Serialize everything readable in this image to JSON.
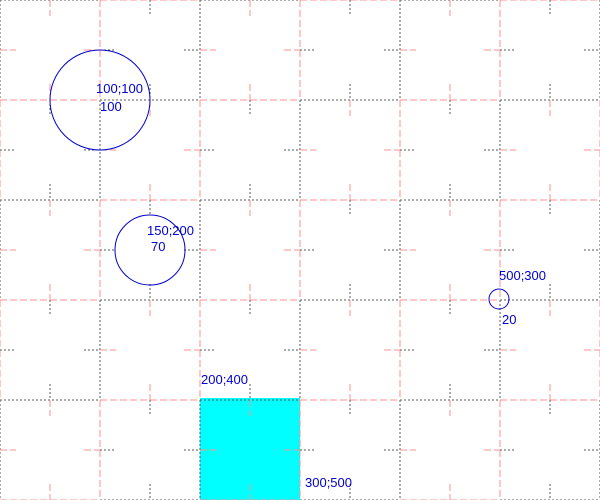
{
  "canvas": {
    "width": 600,
    "height": 500,
    "background_color": "#FFFFFF"
  },
  "grid": {
    "spacing": 100,
    "tick_half_length": 16,
    "dark_color": "#5A5A5A",
    "pink_color": "#FF9191",
    "dark_dash": "2,2",
    "pink_dash": "7,3"
  },
  "shapes": {
    "stroke_color": "#0000CC",
    "circles": [
      {
        "cx": 100,
        "cy": 100,
        "r": 50,
        "coord_label": "100;100",
        "size_label": "100"
      },
      {
        "cx": 150,
        "cy": 250,
        "r": 35,
        "coord_label": "150;200",
        "size_label": "70"
      },
      {
        "cx": 499,
        "cy": 299,
        "r": 10,
        "coord_label": "500;300",
        "size_label": "20"
      }
    ],
    "rect": {
      "x": 200,
      "y": 398,
      "w": 100,
      "h": 102,
      "fill_color": "#00FFFF",
      "top_left_label": "200;400",
      "bottom_right_label": "300;500"
    }
  },
  "annotations": {
    "color": "#0000CC",
    "items": [
      {
        "text": "100;100",
        "x": 96,
        "y": 82
      },
      {
        "text": "100",
        "x": 100,
        "y": 100
      },
      {
        "text": "150;200",
        "x": 147,
        "y": 224
      },
      {
        "text": "70",
        "x": 151,
        "y": 240
      },
      {
        "text": "500;300",
        "x": 499,
        "y": 269
      },
      {
        "text": "20",
        "x": 502,
        "y": 313
      },
      {
        "text": "200;400",
        "x": 201,
        "y": 373
      },
      {
        "text": "300;500",
        "x": 305,
        "y": 476
      }
    ]
  }
}
